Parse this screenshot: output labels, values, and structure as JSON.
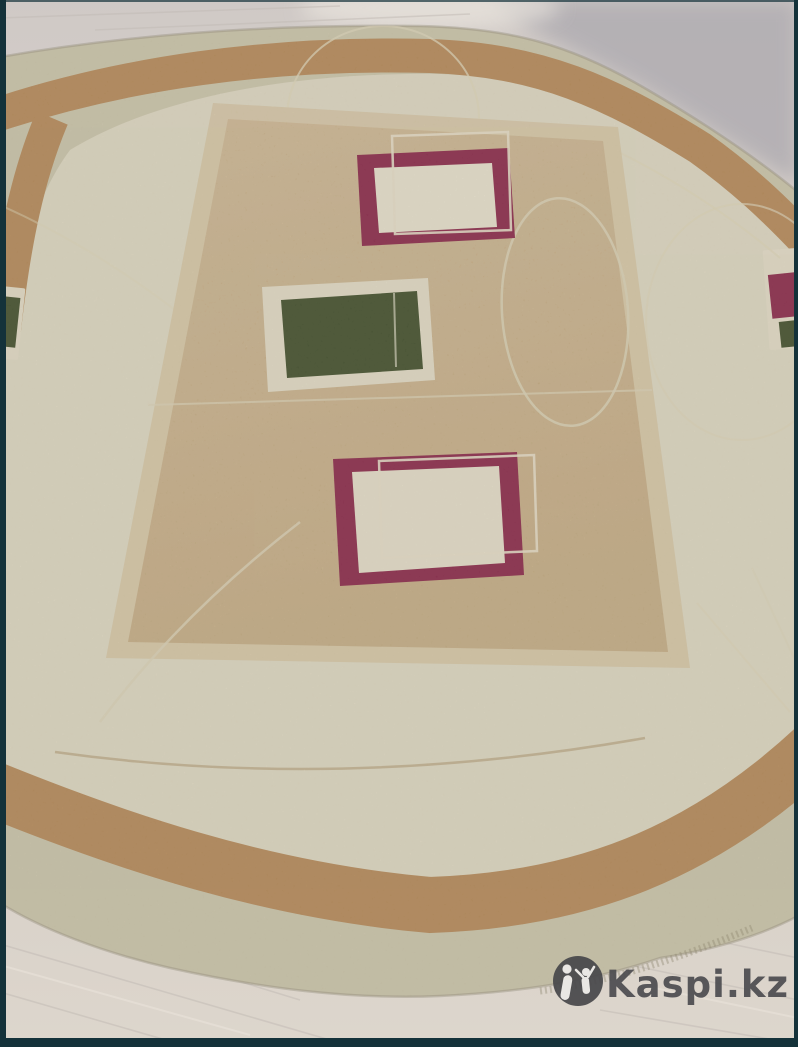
{
  "image": {
    "type": "product-photo",
    "subject": "Oval beige area rug with geometric square medallions photographed on a light laminate wood floor",
    "watermark": {
      "label": "Kaspi.kz",
      "logo": "kaspi-figures-icon",
      "text_color": "#4c4c50",
      "badge_color": "#47474a"
    },
    "colors": {
      "floor": "#d6cfc9",
      "floor_gray_corner": "#b2afb3",
      "rug_margin": "#ccc5ab",
      "rug_field": "#ded7c1",
      "rug_band": "#b78c5c",
      "panel": "#c2a77e",
      "panel_frame": "#d7c8a8",
      "maroon": "#8e2f4e",
      "green": "#485431",
      "accent_line": "#ddd4b8",
      "photo_border": "#14323a"
    }
  }
}
